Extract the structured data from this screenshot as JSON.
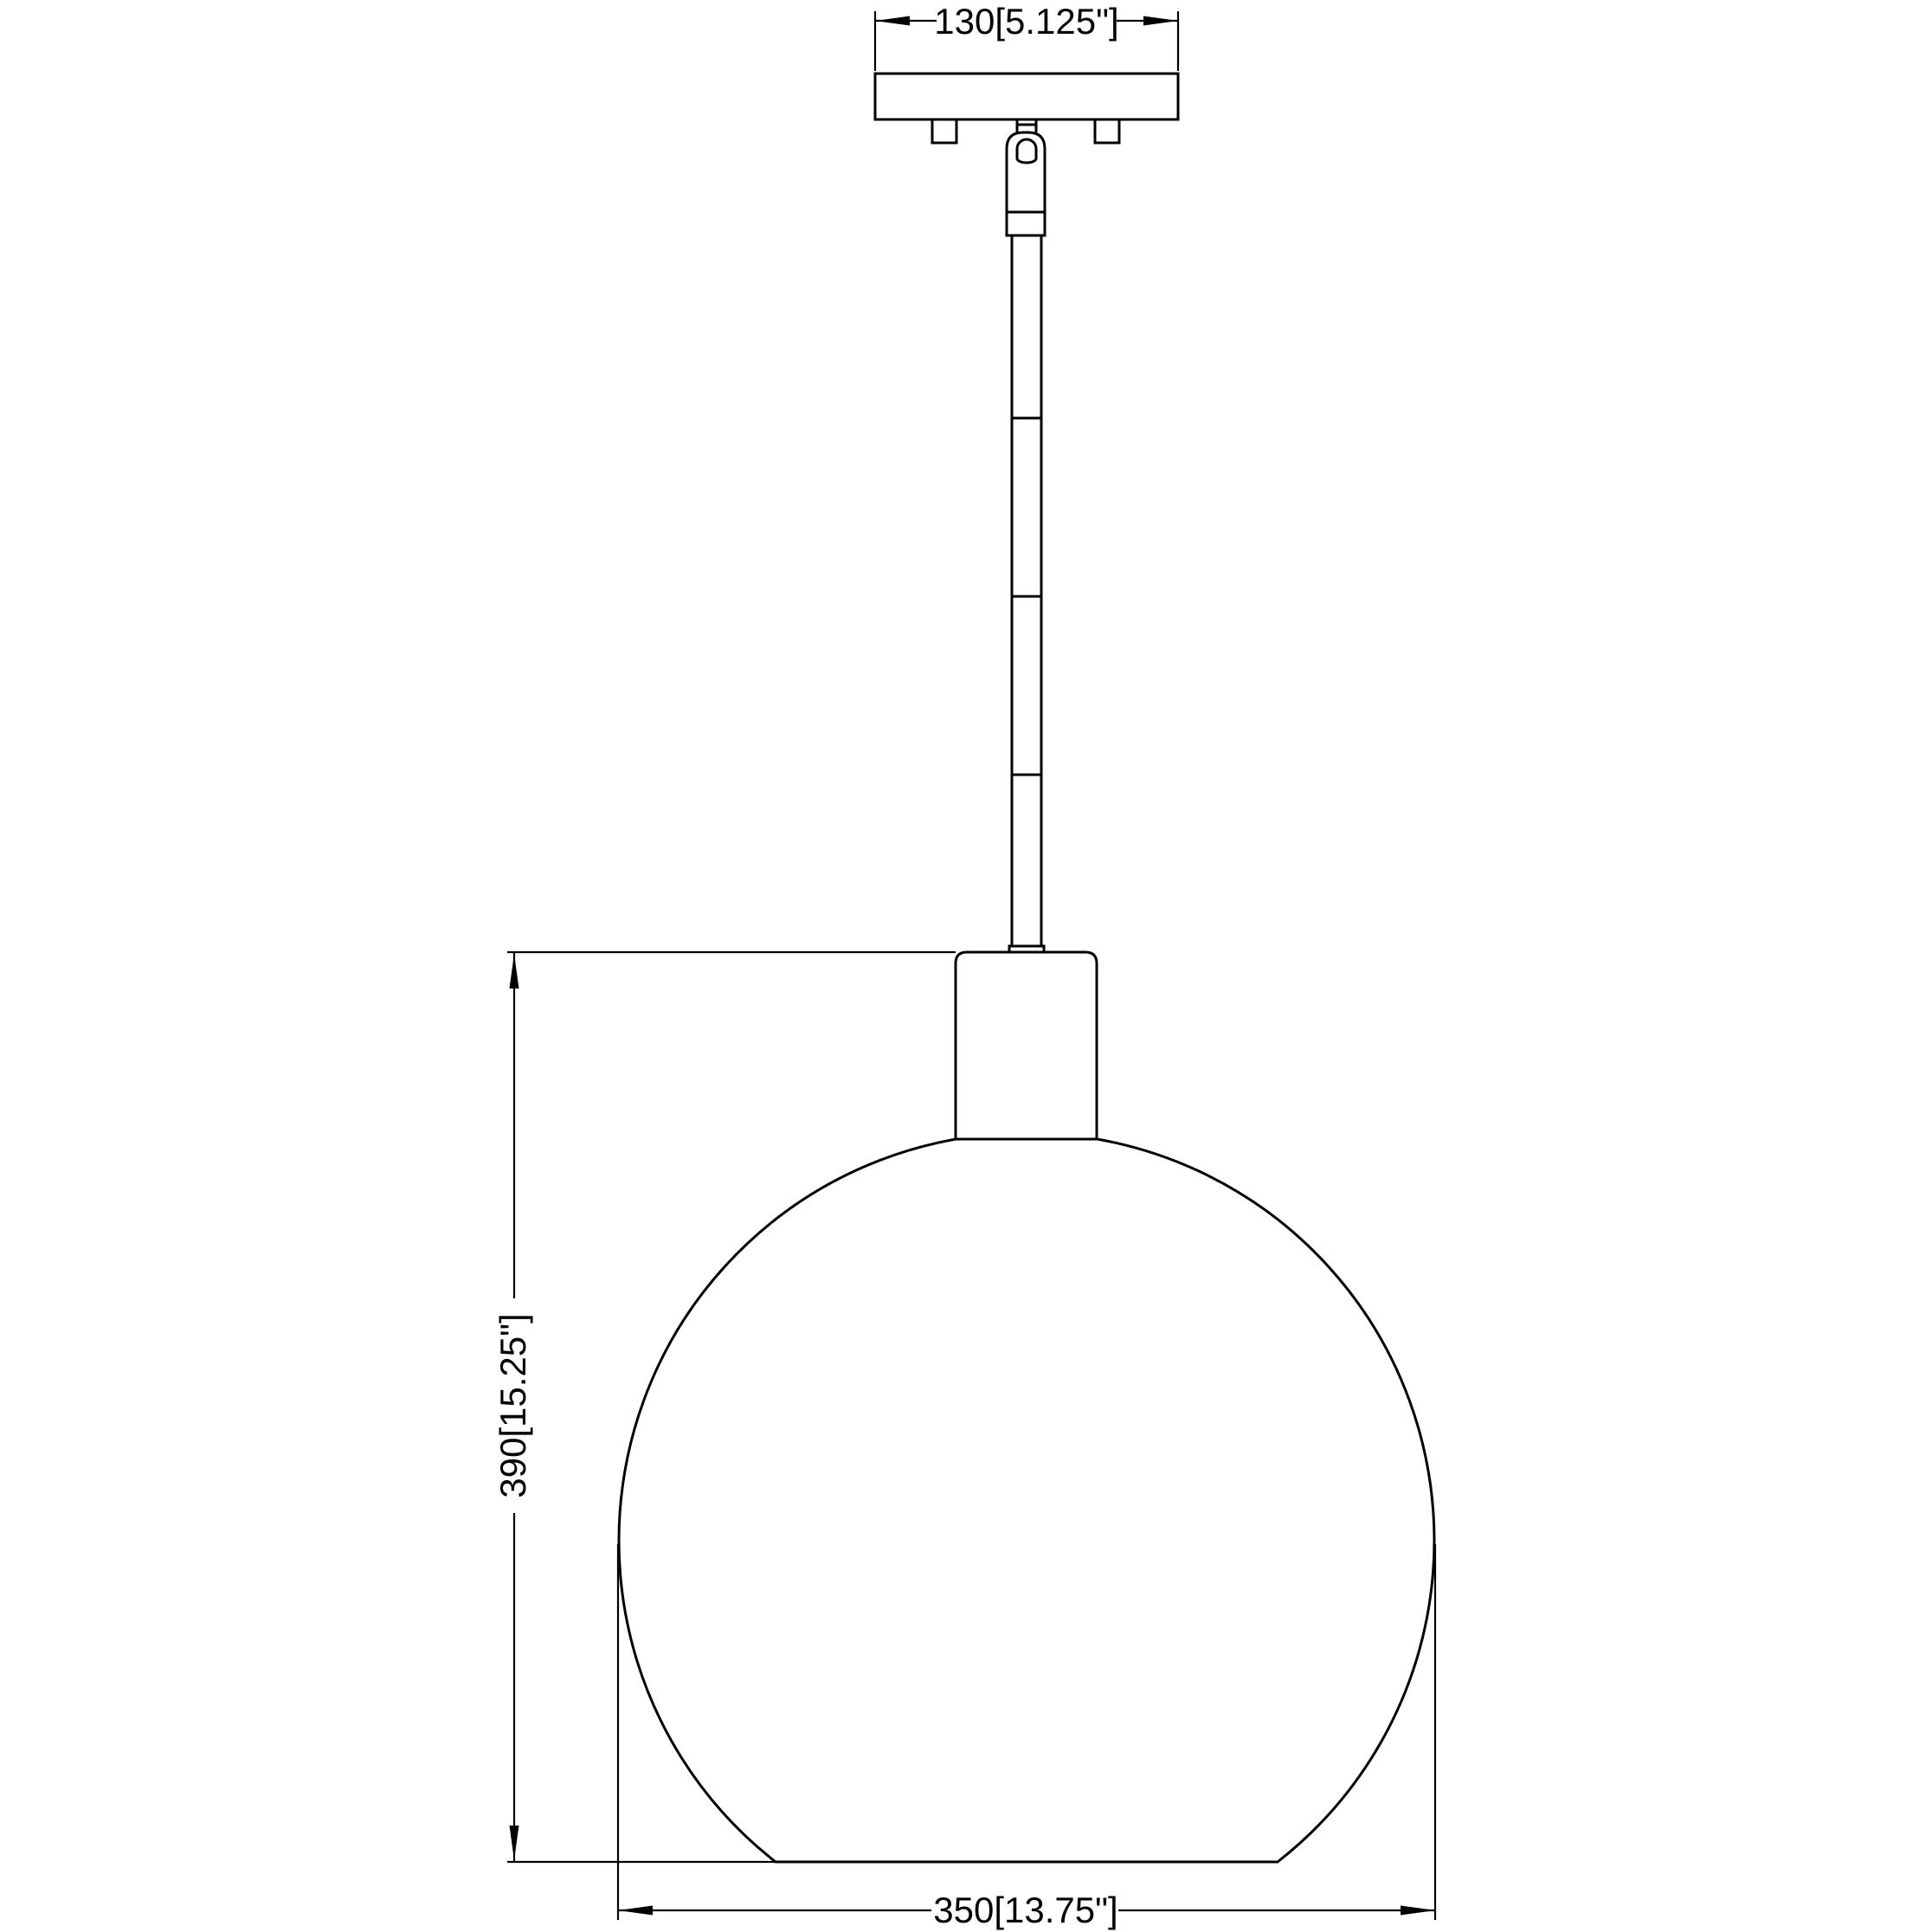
{
  "page": {
    "background_color": "#ffffff",
    "line_color": "#000000"
  },
  "drawing": {
    "type": "technical-dimension-drawing",
    "subject": "globe pendant light fixture line drawing",
    "labels": {
      "canopy_width": "130[5.125\"]",
      "fixture_height": "390[15.25\"]",
      "shade_diameter": "350[13.75\"]"
    }
  }
}
